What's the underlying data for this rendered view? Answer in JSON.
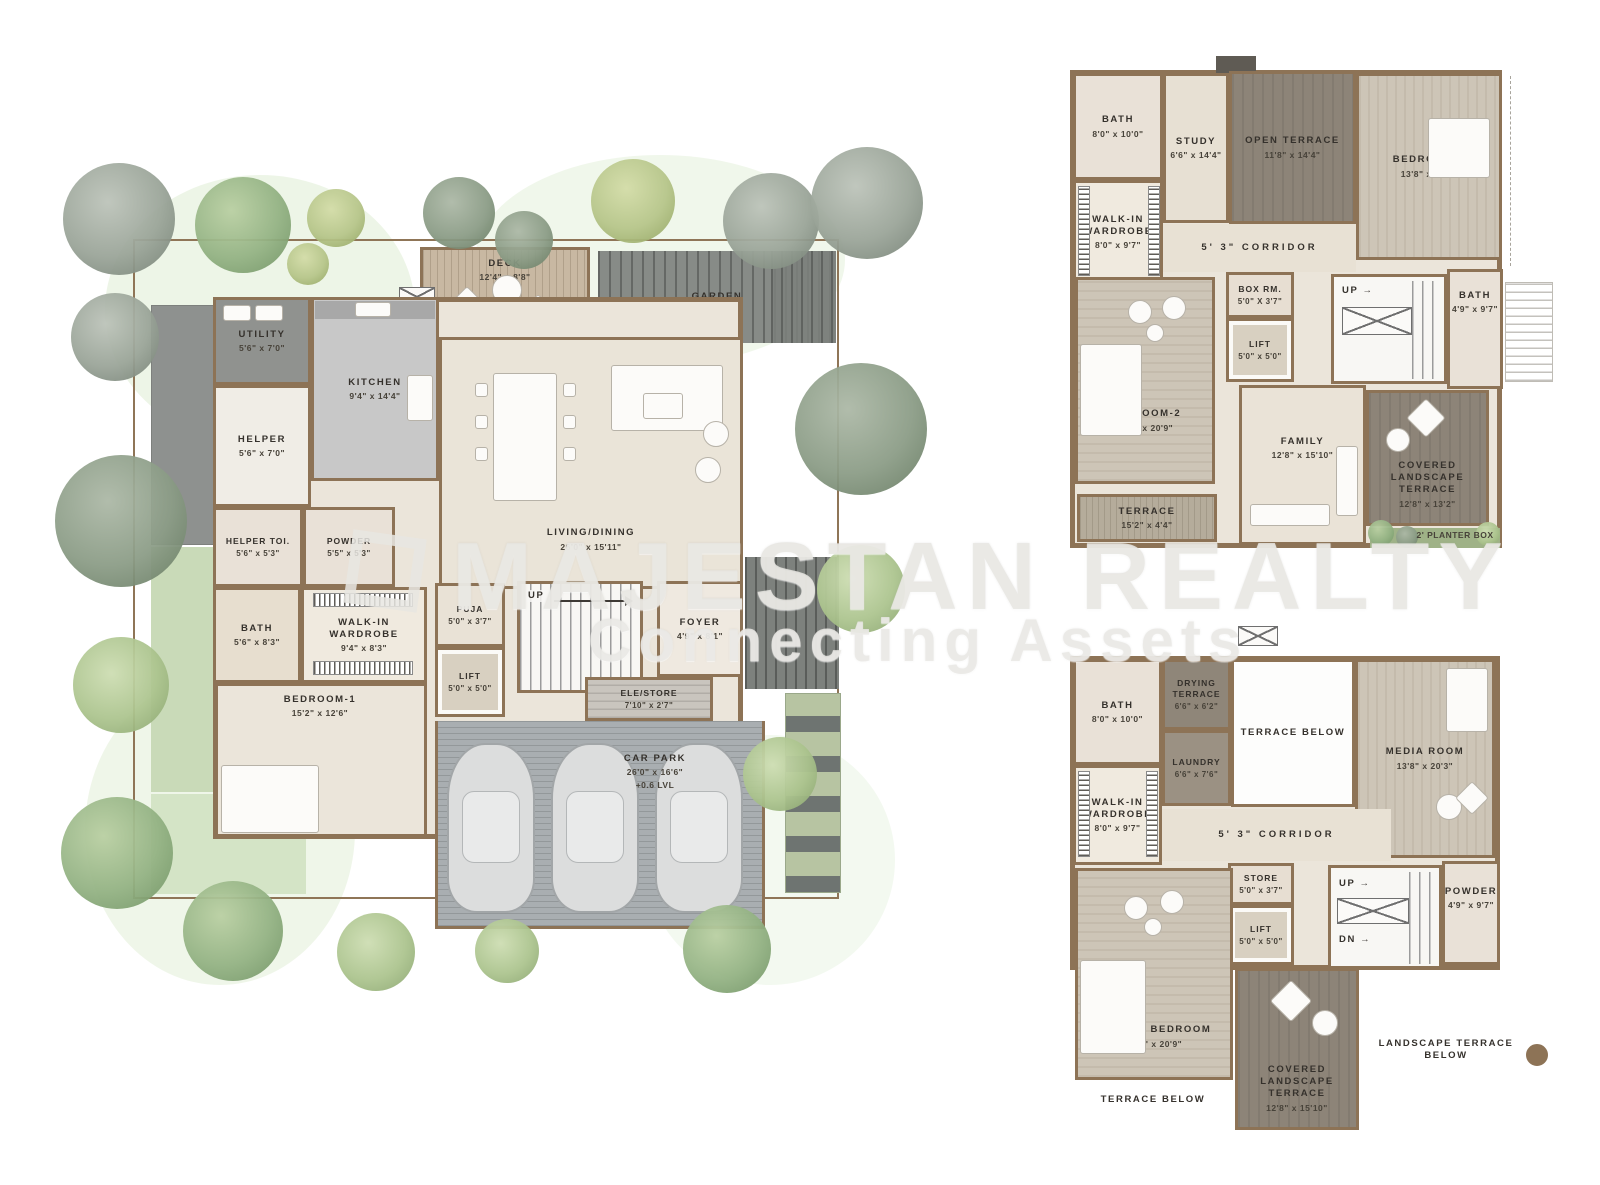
{
  "watermark": {
    "brand": "MAJESTAN REALTY",
    "tagline": "Connecting Assets"
  },
  "ground_floor": {
    "deck": {
      "label": "DECK",
      "dims": "12'4\" x 8'8\""
    },
    "garden": {
      "label": "GARDEN"
    },
    "utility": {
      "label": "UTILITY",
      "dims": "5'6\" x 7'0\""
    },
    "kitchen": {
      "label": "KITCHEN",
      "dims": "9'4\" x 14'4\""
    },
    "helper": {
      "label": "HELPER",
      "dims": "5'6\" x 7'0\""
    },
    "helper_toi": {
      "label": "HELPER TOI.",
      "dims": "5'6\" x 5'3\""
    },
    "powder": {
      "label": "POWDER",
      "dims": "5'5\" x 5'3\""
    },
    "living_dining": {
      "label": "LIVING/DINING",
      "dims": "26'0\" x 15'11\""
    },
    "bath": {
      "label": "BATH",
      "dims": "5'6\" x 8'3\""
    },
    "walk_in_wardrobe": {
      "label": "WALK-IN WARDROBE",
      "dims": "9'4\" x 8'3\""
    },
    "puja": {
      "label": "PUJA",
      "dims": "5'0\" x 3'7\""
    },
    "lift": {
      "label": "LIFT",
      "dims": "5'0\" x 5'0\""
    },
    "up": {
      "label": "UP"
    },
    "foyer": {
      "label": "FOYER",
      "dims": "4'9\" x 8'1\""
    },
    "ele_store": {
      "label": "ELE/STORE",
      "dims": "7'10\" x 2'7\""
    },
    "bedroom1": {
      "label": "BEDROOM-1",
      "dims": "15'2\" x 12'6\""
    },
    "car_park": {
      "label": "CAR PARK",
      "dims": "26'0\" x 16'6\"",
      "extra": "+0.6 LVL"
    }
  },
  "first_floor": {
    "bath": {
      "label": "BATH",
      "dims": "8'0\" x 10'0\""
    },
    "study": {
      "label": "STUDY",
      "dims": "6'6\" x 14'4\""
    },
    "open_terrace": {
      "label": "OPEN TERRACE",
      "dims": "11'8\" x 14'4\""
    },
    "bedroom3": {
      "label": "BEDROOM-3",
      "dims": "13'8\" x 20'3\""
    },
    "walk_in_wardrobe": {
      "label": "WALK-IN WARDROBE",
      "dims": "8'0\" x 9'7\""
    },
    "corridor": {
      "label": "5' 3\" CORRIDOR"
    },
    "box_room": {
      "label": "BOX RM.",
      "dims": "5'0\" X 3'7\""
    },
    "lift": {
      "label": "LIFT",
      "dims": "5'0\" x 5'0\""
    },
    "up": {
      "label": "UP →"
    },
    "bath2": {
      "label": "BATH",
      "dims": "4'9\" x 9'7\""
    },
    "bedroom2": {
      "label": "BEDROOM-2",
      "dims": "15'2\" x 20'9\""
    },
    "family": {
      "label": "FAMILY",
      "dims": "12'8\" x 15'10\""
    },
    "terrace": {
      "label": "TERRACE",
      "dims": "15'2\" x 4'4\""
    },
    "covered_landscape_terrace": {
      "label": "COVERED LANDSCAPE TERRACE",
      "dims": "12'8\" x 13'2\""
    },
    "planter_box": {
      "label": "2' PLANTER BOX"
    }
  },
  "second_floor": {
    "bath": {
      "label": "BATH",
      "dims": "8'0\" x 10'0\""
    },
    "drying_terrace": {
      "label": "DRYING TERRACE",
      "dims": "6'6\" x 6'2\""
    },
    "laundry": {
      "label": "LAUNDRY",
      "dims": "6'6\" x 7'6\""
    },
    "terrace_below_top": {
      "label": "TERRACE BELOW"
    },
    "media_room": {
      "label": "MEDIA ROOM",
      "dims": "13'8\" x 20'3\""
    },
    "walk_in_wardrobe": {
      "label": "WALK-IN WARDROBE",
      "dims": "8'0\" x 9'7\""
    },
    "corridor": {
      "label": "5' 3\" CORRIDOR"
    },
    "store": {
      "label": "STORE",
      "dims": "5'0\" x 3'7\""
    },
    "lift": {
      "label": "LIFT",
      "dims": "5'0\" x 5'0\""
    },
    "up": {
      "label": "UP →"
    },
    "dn": {
      "label": "DN →"
    },
    "powder": {
      "label": "POWDER",
      "dims": "4'9\" x 9'7\""
    },
    "master_bedroom": {
      "label": "MASTER BEDROOM",
      "dims": "15'2\" x 20'9\""
    },
    "covered_landscape_terrace": {
      "label": "COVERED LANDSCAPE TERRACE",
      "dims": "12'8\" x 15'10\""
    },
    "landscape_terrace_below": {
      "label": "LANDSCAPE TERRACE BELOW"
    },
    "terrace_below_bottom": {
      "label": "TERRACE BELOW"
    }
  },
  "palette": {
    "wall": "#8d7356",
    "floor_light": "#ebe5da",
    "floor_wood": "#cdc5b7",
    "terrace_dark": "#8d8478",
    "deck_wood": "#c8b8a2",
    "paver_gray": "#878b87",
    "car_park_gray": "#a9aeb1",
    "lawn_green": "#c9dab8",
    "tree_green": "#93b283",
    "tree_gray": "#99a396",
    "watermark_gray": "#e7e6e2"
  }
}
